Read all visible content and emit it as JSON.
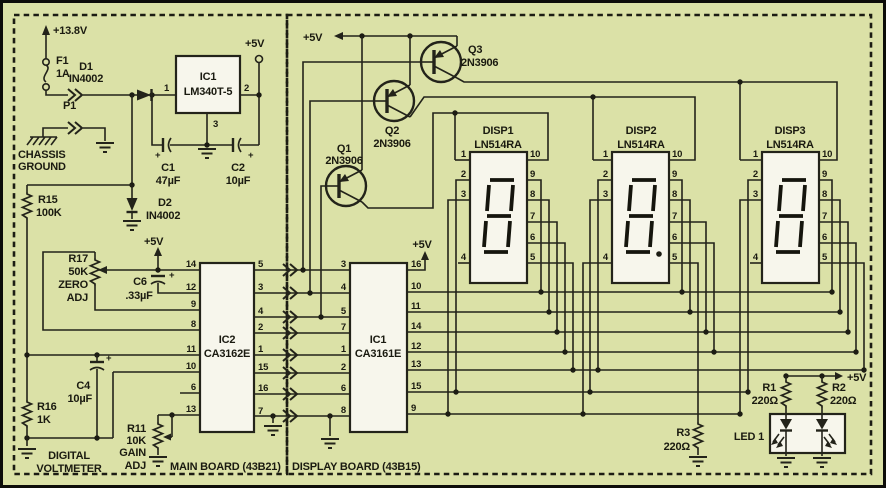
{
  "rails": {
    "v_in": "+13.8V",
    "v5": "+5V"
  },
  "symbols": {
    "plus": "+"
  },
  "main_board": {
    "board_label": "MAIN BOARD (43B21)",
    "title": {
      "line1": "DIGITAL",
      "line2": "VOLTMETER"
    },
    "chassis": {
      "line1": "CHASSIS",
      "line2": "GROUND"
    },
    "f1": {
      "ref": "F1",
      "value": "1A"
    },
    "p1": {
      "ref": "P1"
    },
    "d1": {
      "ref": "D1",
      "value": "IN4002"
    },
    "d2": {
      "ref": "D2",
      "value": "IN4002"
    },
    "reg": {
      "ref": "IC1",
      "value": "LM340T-5",
      "pin_in": "1",
      "pin_out": "2",
      "pin_gnd": "3"
    },
    "c1": {
      "ref": "C1",
      "value": "47µF"
    },
    "c2": {
      "ref": "C2",
      "value": "10µF"
    },
    "c4": {
      "ref": "C4",
      "value": "10µF"
    },
    "c6": {
      "ref": "C6",
      "value": ".33µF"
    },
    "r15": {
      "ref": "R15",
      "value": "100K"
    },
    "r16": {
      "ref": "R16",
      "value": "1K"
    },
    "r17": {
      "ref": "R17",
      "value": "50K",
      "func1": "ZERO",
      "func2": "ADJ"
    },
    "r11": {
      "ref": "R11",
      "value": "10K",
      "func1": "GAIN",
      "func2": "ADJ"
    },
    "ic2": {
      "ref": "IC2",
      "value": "CA3162E",
      "left_pins": [
        "14",
        "12",
        "9",
        "8",
        "11",
        "10",
        "6",
        "13"
      ],
      "right_pins": [
        "5",
        "3",
        "4",
        "2",
        "1",
        "15",
        "16",
        "7"
      ]
    }
  },
  "display_board": {
    "board_label": "DISPLAY BOARD (43B15)",
    "q1": {
      "ref": "Q1",
      "value": "2N3906"
    },
    "q2": {
      "ref": "Q2",
      "value": "2N3906"
    },
    "q3": {
      "ref": "Q3",
      "value": "2N3906"
    },
    "ic1": {
      "ref": "IC1",
      "value": "CA3161E",
      "left_pins": [
        "3",
        "4",
        "5",
        "7",
        "1",
        "2",
        "6",
        "8"
      ],
      "right_pins": [
        "16",
        "10",
        "11",
        "14",
        "12",
        "13",
        "15",
        "9"
      ]
    },
    "disp_pins": {
      "left": [
        "1",
        "2",
        "3",
        "4"
      ],
      "right": [
        "10",
        "9",
        "8",
        "7",
        "6",
        "5"
      ]
    },
    "disp1": {
      "ref": "DISP1",
      "value": "LN514RA"
    },
    "disp2": {
      "ref": "DISP2",
      "value": "LN514RA"
    },
    "disp3": {
      "ref": "DISP3",
      "value": "LN514RA"
    },
    "r1": {
      "ref": "R1",
      "value": "220Ω"
    },
    "r2": {
      "ref": "R2",
      "value": "220Ω"
    },
    "r3": {
      "ref": "R3",
      "value": "220Ω"
    },
    "led1": {
      "ref": "LED 1"
    }
  }
}
